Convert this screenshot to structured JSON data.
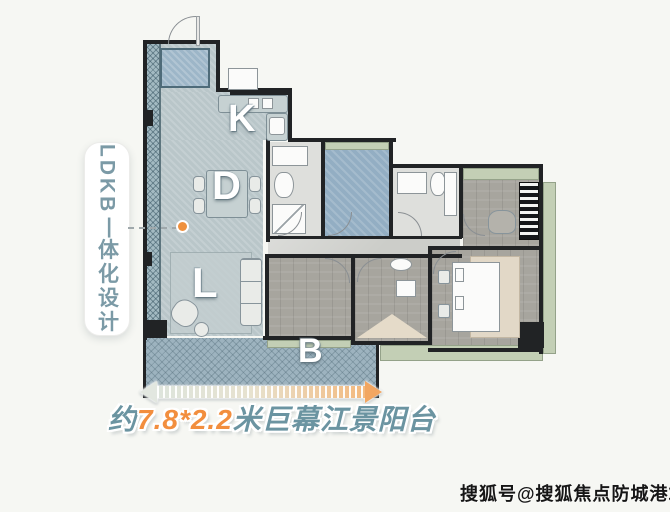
{
  "side_label": {
    "latin": "LDKB",
    "separator": "一",
    "chinese": "体化设计"
  },
  "rooms": {
    "kitchen": "K",
    "dining": "D",
    "living": "L",
    "balcony": "B"
  },
  "dimension": {
    "prefix": "约",
    "value": "7.8*2.2",
    "suffix": "米巨幕江景阳台"
  },
  "watermark": "搜狐号@搜狐焦点防城港站",
  "colors": {
    "accent_orange": "#f28e3e",
    "label_teal": "#6b94a1",
    "ldk_floor_teal": "#b9c6c9",
    "balcony_blue": "#9db3bf",
    "green_trim": "#c3cfb5",
    "wall_black": "#212325",
    "background": "#f6f7f3"
  }
}
